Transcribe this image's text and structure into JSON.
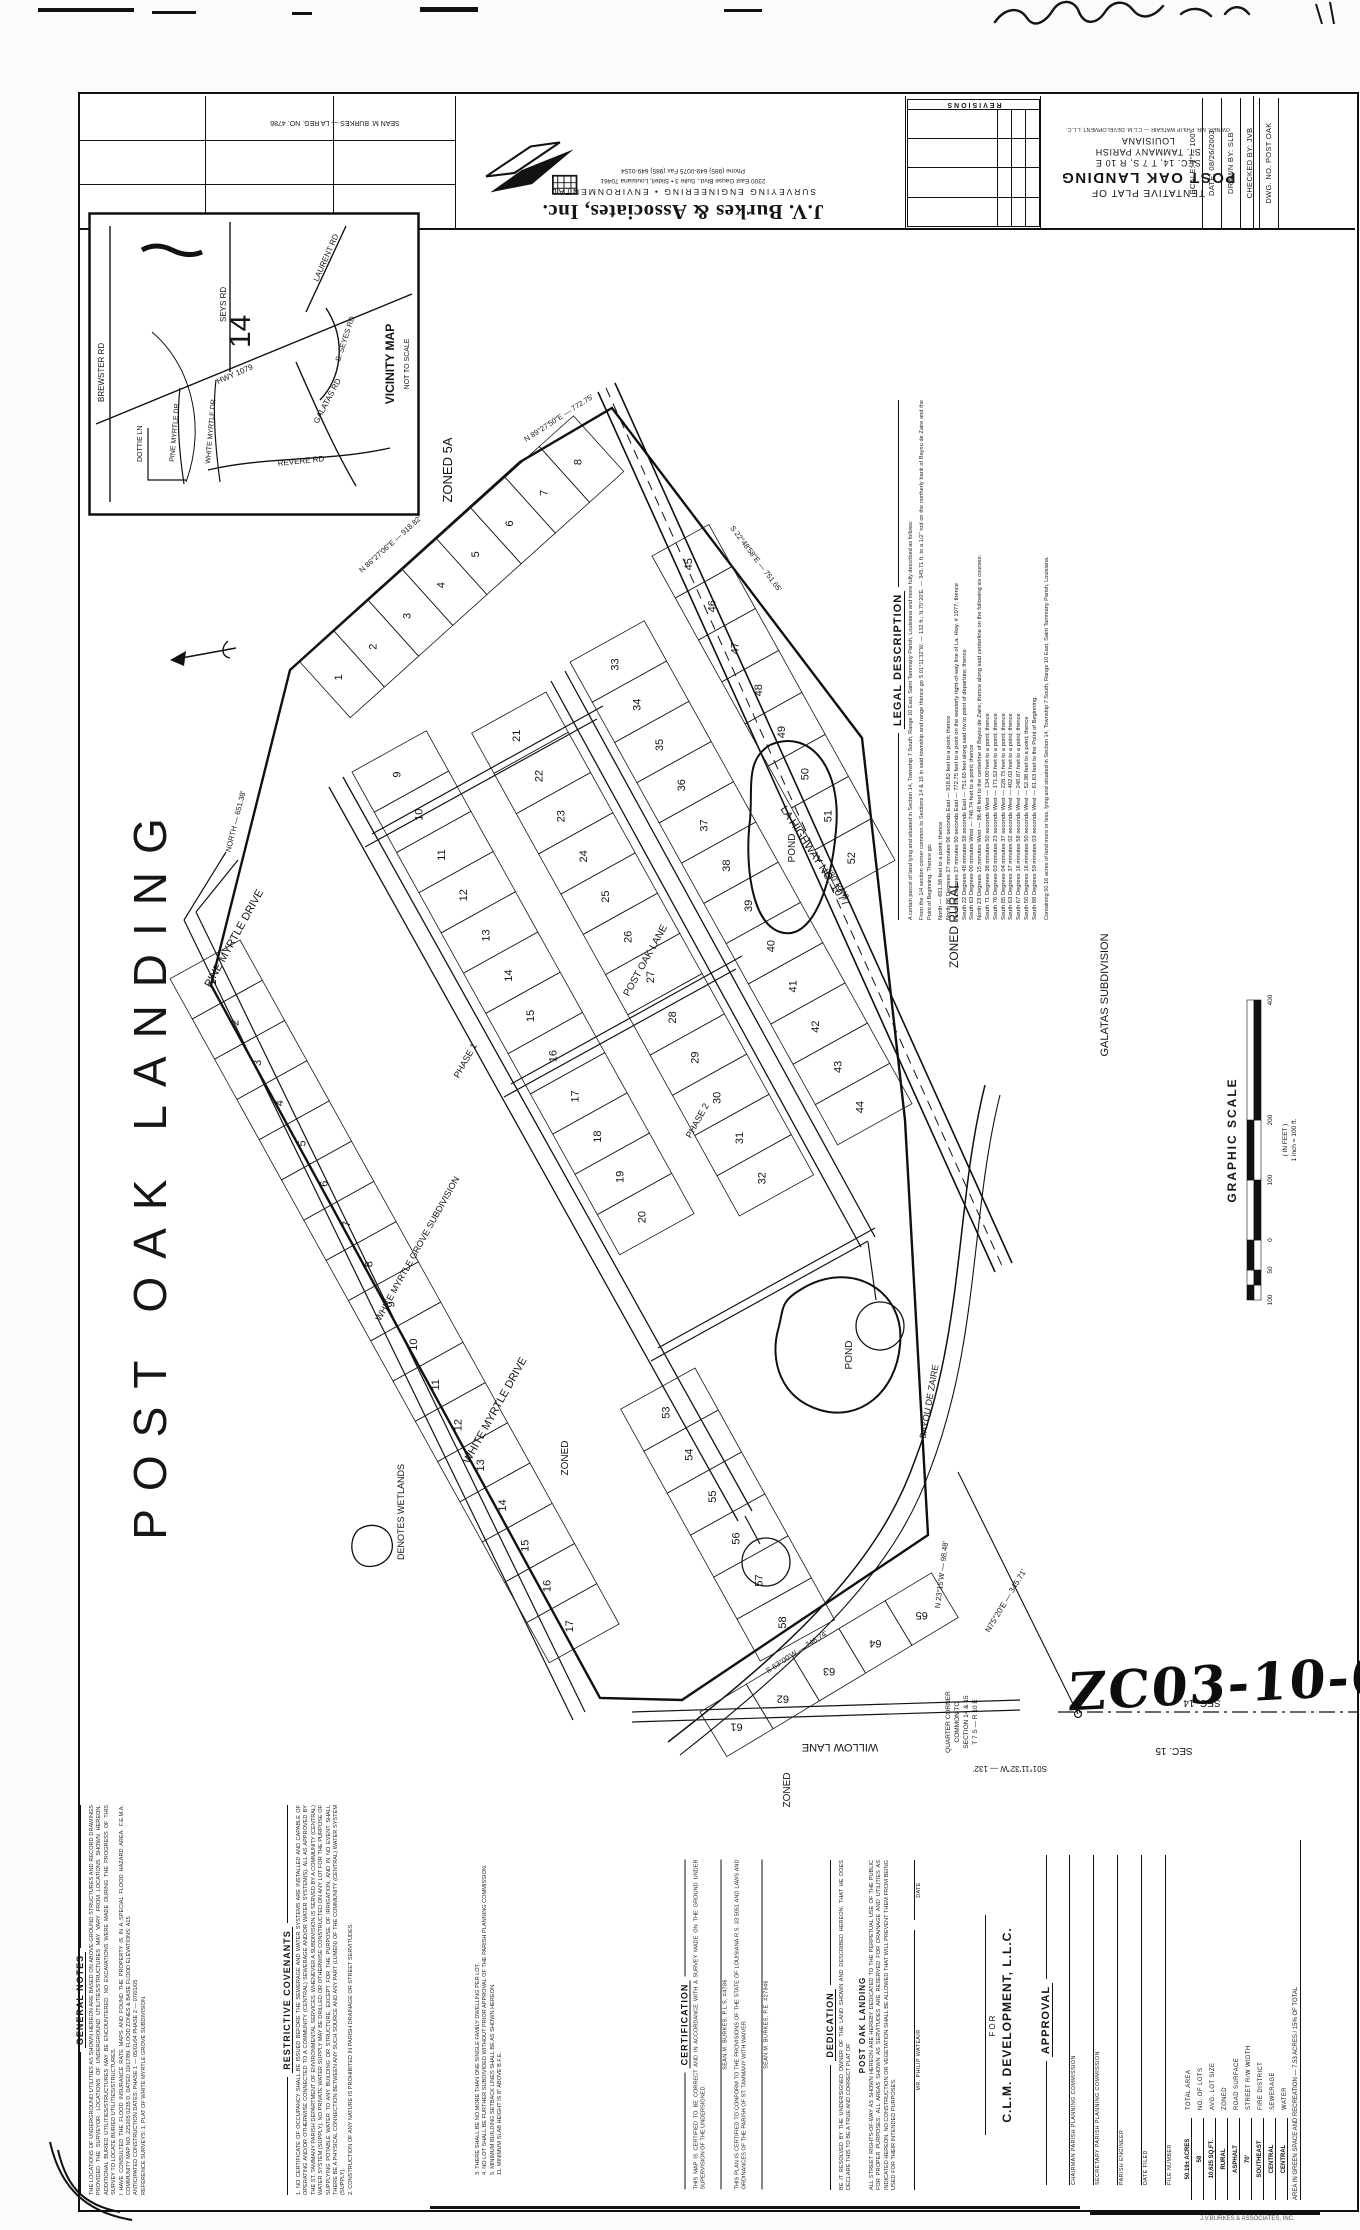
{
  "scan": {
    "case_number": "ZC03-10-067",
    "corner_stamp": "J.V.BURKES & ASSOCIATES, INC."
  },
  "title_block": {
    "surveyor_line": "SEAN M. BURKES — LA REG. NO. 4786",
    "firm_name": "J.V. Burkes & Associates, Inc.",
    "firm_services": "SURVEYING      ENGINEERING • ENVIRONMENTAL",
    "firm_address": "2300 East Gause Blvd., Suite 3  •  Slidell, Louisiana 70461",
    "firm_phone": "Phone (985) 649-0075      Fax (985) 649-0154",
    "revisions_title": "REVISIONS",
    "plat_title_line1": "TENTATIVE PLAT OF",
    "plat_title_line2": "POST OAK LANDING",
    "plat_title_line3": "SEC. 14, T 7 S, R 10 E",
    "plat_title_line4": "ST. TAMMANY PARISH",
    "plat_title_line5": "LOUISIANA",
    "owner_note": "OWNER: MR. PHILIP WATEAIR — C.L.M. DEVELOPMENT, L.L.C.",
    "fields": [
      "SCALE:  1\" = 100'",
      "DATE:  08/26/2003",
      "DRAWN BY:  SLB",
      "CHECKED BY:  JVB",
      "DWG. NO.  POST OAK"
    ]
  },
  "vicinity": {
    "title": "VICINITY MAP",
    "subtitle": "NOT TO SCALE",
    "section_number": "14",
    "roads": {
      "brewster": "BREWSTER RD",
      "hwy1079": "HWY 1079",
      "seys": "SEYS RD",
      "laurent": "LAURENT RD",
      "sseyes": "S. SEYES RD",
      "galatas": "GALATAS RD",
      "revere": "REVERE RD",
      "dottie": "DOTTIE LN",
      "pinemyrtle": "PINE MYRTLE DR",
      "whitemyrtle": "WHITE MYRTLE DR"
    }
  },
  "page_title": "POST OAK LANDING",
  "legal": {
    "heading": "LEGAL DESCRIPTION",
    "intro1": "A certain parcel of land lying and situated in Section 14, Township 7 South, Range 10 East, Saint Tammany Parish, Louisiana and more fully described as follows:",
    "intro2": "From the 1/4 section corner common to Sections 14 & 15 in said township and range thence go S.01°11'32\"W. — 132 ft.;  N.75°20'E. — 345.71 ft. to a 1/2\" rod on the northerly bank of Bayou de Zaire and the Point of Beginning. Thence go:",
    "courses": [
      "North — 651.38 feet to a point; thence",
      "North 86 Degrees 27 minutes 06 seconds East — 918.82 feet to a point; thence",
      "North 89 Degrees 27 minutes 50 seconds East — 772.75 feet to a point on the westerly right-of-way line of La. Hwy. # 1077; thence",
      "South 22 Degrees 48 minutes 58 seconds East — 751.65 feet along said r/w to point of departure; thence",
      "South 63 Degrees 00 minutes West — 746.74 feet to a point; thence",
      "North 23 Degrees 15 minutes West — 98.48 feet to the centerline of Bayou de Zaire; thence along said centerline on the following six courses:",
      "South 71 Degrees 38 minutes 50 seconds West — 134.00 feet to a point; thence",
      "South 76 Degrees 03 minutes 23 seconds West — 171.52 feet to a point; thence",
      "South 85 Degrees 04 minutes 37 seconds West — 228.75 feet to a point; thence",
      "South 63 Degrees 37 minutes 02 seconds West — 402.02 feet to a point; thence",
      "South 67 Degrees 16 minutes 58 seconds West — 240.87 feet to a point; thence",
      "South 50 Degrees 16 minutes 50 seconds West — 52.98 feet to a point; thence",
      "South 88 Degrees 59 minutes 03 seconds West — 61.63 feet to the Point of Beginning."
    ],
    "closing": "Containing 50.16 acres of land more or less, lying and situated in Section 14, Township 7 South, Range 10 East, Saint Tammany Parish, Louisiana."
  },
  "scalebar": {
    "title": "GRAPHIC SCALE",
    "units": "( IN FEET )",
    "ratio": "1 inch = 100 ft.",
    "segments": [
      15,
      15,
      30,
      60,
      60,
      120
    ],
    "ticks": [
      {
        "x": 5,
        "t": "100"
      },
      {
        "x": 35,
        "t": "50"
      },
      {
        "x": 65,
        "t": "0"
      },
      {
        "x": 125,
        "t": "100"
      },
      {
        "x": 185,
        "t": "200"
      },
      {
        "x": 305,
        "t": "400"
      }
    ]
  },
  "notes": {
    "heading": "GENERAL NOTES",
    "items": [
      "THE LOCATIONS OF UNDERGROUND UTILITIES AS SHOWN HEREON ARE BASED ON ABOVE-GROUND STRUCTURES AND RECORD DRAWINGS PROVIDED THE SURVEYOR. LOCATIONS OF UNDERGROUND UTILITIES/STRUCTURES MAY VARY FROM LOCATIONS SHOWN HEREON. ADDITIONAL BURIED UTILITIES/STRUCTURES MAY BE ENCOUNTERED. NO EXCAVATIONS WERE MADE DURING THE PROGRESS OF THIS SURVEY TO LOCATE BURIED UTILITIES/STRUCTURES.",
      "I HAVE CONSULTED THE FLOOD INSURANCE RATE MAPS AND FOUND THE PROPERTY IS IN A SPECIAL FLOOD HAZARD AREA.  F.E.M.A. COMMUNITY MAP NO. 225205 0235 D, DATED 10/17/89.  FLOOD ZONES & BASE FLOOD ELEVATIONS: A15",
      "ANTICIPATED CONSTRUCTION DATES:   PHASE 1 — 05/01/04    PHASE 2 — 07/01/05",
      "REFERENCE SURVEYS:   1. PLAT OF WHITE MYRTLE GROVE SUBDIVISION."
    ]
  },
  "covenants": {
    "heading": "RESTRICTIVE COVENANTS",
    "items": [
      "1.  NO CERTIFICATE OF OCCUPANCY SHALL BE ISSUED BEFORE THE SEWERAGE AND WATER SYSTEMS ARE INSTALLED AND CAPABLE OF OPERATING AND/OR OTHERWISE CONNECTED TO A COMMUNITY (CENTRAL) SEWERAGE AND/OR WATER SYSTEM(S), ALL AS APPROVED BY THE ST. TAMMANY PARISH DEPARTMENT OF ENVIRONMENTAL SERVICES. WHENEVER A SUBDIVISION IS SERVED BY A COMMUNITY (CENTRAL) WATER SYSTEM (SUPPLY), NO PRIVATE WATER SUPPLY MAY BE DRILLED OR OTHERWISE CONSTRUCTED ON ANY LOT FOR THE PURPOSE OF SUPPLYING POTABLE WATER TO ANY BUILDING OR STRUCTURE, EXCEPT FOR THE PURPOSE OF IRRIGATION, AND IN NO EVENT SHALL THERE BE A PHYSICAL CONNECTION BETWEEN ANY SUCH SOURCE AND ANY PART (LUMEN) OF THE COMMUNITY (CENTRAL) WATER SYSTEM (SUPPLY).",
      "2.  CONSTRUCTION OF ANY NATURE IS PROHIBITED IN PARISH DRAINAGE OR STREET SERVITUDES."
    ],
    "cont": [
      "3.  THERE SHALL BE NO MORE THAN ONE SINGLE FAMILY DWELLING PER LOT.",
      "4.  NO LOT SHALL BE FURTHER SUBDIVIDED WITHOUT PRIOR APPROVAL OF THE PARISH PLANNING COMMISSION.",
      "5.  MINIMUM BUILDING SETBACK LINES SHALL BE AS SHOWN HEREON.",
      "11. MINIMUM SLAB HEIGHT IS 8\" ABOVE B.F.E."
    ]
  },
  "certification": {
    "heading": "CERTIFICATION",
    "p1": "THIS MAP IS CERTIFIED TO BE CORRECT AND IN ACCORDANCE WITH A SURVEY MADE ON THE GROUND UNDER SUPERVISION OF THE UNDERSIGNED.",
    "sig1": "SEAN M. BURKES, P.L.S. #4786",
    "p2": "THIS PLAN IS CERTIFIED TO CONFORM TO THE PROVISIONS OF THE STATE OF LOUISIANA R.S. 33:5051 AND LAWS AND ORDINANCES OF THE PARISH OF ST. TAMMANY WITH WAIVER.",
    "sig2": "SEAN M. BURKES, P.E. #27946"
  },
  "dedication": {
    "heading": "DEDICATION",
    "p1": "BE IT RESOLVED BY THE UNDERSIGNED OWNER OF THE LAND SHOWN AND DESCRIBED HEREON, THAT HE DOES DECLARE THIS TO BE A TRUE AND CORRECT PLAT OF",
    "project": "POST OAK LANDING",
    "p2": "ALL STREET RIGHTS-OF-WAY AS SHOWN HEREON ARE HEREBY DEDICATED TO THE PERPETUAL USE OF THE PUBLIC FOR PROPER PURPOSES. ALL AREAS SHOWN AS SERVITUDES ARE RESERVED FOR DRAINAGE AND UTILITIES AS INDICATED HEREON. NO CONSTRUCTION OR VEGETATION SHALL BE ALLOWED THAT WILL PREVENT THEM FROM BEING USED FOR THEIR INTENDED PURPOSES.",
    "sig_owner": "MR. PHILIP WATEAIR",
    "sig_date": "DATE"
  },
  "owner_block": {
    "for_label": "FOR",
    "owner": "C.L.M. DEVELOPMENT, L.L.C."
  },
  "approval": {
    "heading": "APPROVAL",
    "lines": [
      "CHAIRMAN PARISH PLANNING COMMISSION",
      "SECRETARY PARISH PLANNING COMMISSION",
      "PARISH ENGINEER",
      "DATE FILED",
      "FILE NUMBER"
    ]
  },
  "site_data": {
    "rows": [
      {
        "v": "50.19± ACRES",
        "l": "TOTAL AREA"
      },
      {
        "v": "58",
        "l": "NO. OF LOTS"
      },
      {
        "v": "10,625 SQ.FT.",
        "l": "AVG. LOT SIZE"
      },
      {
        "v": "RURAL",
        "l": "ZONED"
      },
      {
        "v": "ASPHALT",
        "l": "ROAD SURFACE"
      },
      {
        "v": "70'",
        "l": "STREET R/W WIDTH"
      },
      {
        "v": "SOUTHEAST",
        "l": "FIRE DISTRICT"
      },
      {
        "v": "CENTRAL",
        "l": "SEWERAGE"
      },
      {
        "v": "CENTRAL",
        "l": "WATER"
      }
    ],
    "green": "AREA IN GREEN SPACE AND RECREATION — 7.53 ACRES / 15% OF TOTAL"
  },
  "plat": {
    "labels": [
      {
        "t": "ZONED 5A",
        "x": 452,
        "y": 470,
        "r": -90,
        "s": 13
      },
      {
        "t": "LA HIGHWAY NO. 1077",
        "x": 812,
        "y": 858,
        "r": 57,
        "s": 11
      },
      {
        "t": "(80' R/W)",
        "x": 836,
        "y": 886,
        "r": 57,
        "s": 8
      },
      {
        "t": "PINE MYRTLE DRIVE",
        "x": 237,
        "y": 940,
        "r": -61,
        "s": 11
      },
      {
        "t": "WHITE MYRTLE GROVE SUBDIVISION",
        "x": 420,
        "y": 1250,
        "r": -61,
        "s": 9
      },
      {
        "t": "WHITE MYRTLE DRIVE",
        "x": 498,
        "y": 1412,
        "r": -61,
        "s": 11
      },
      {
        "t": "POST OAK LANE",
        "x": 648,
        "y": 962,
        "r": -61,
        "s": 10
      },
      {
        "t": "POND",
        "x": 795,
        "y": 848,
        "r": -90,
        "s": 10
      },
      {
        "t": "POND",
        "x": 852,
        "y": 1355,
        "r": -90,
        "s": 10
      },
      {
        "t": "ZONED RURAL",
        "x": 958,
        "y": 925,
        "r": -90,
        "s": 12
      },
      {
        "t": "GALATAS SUBDIVISION",
        "x": 1108,
        "y": 995,
        "r": -90,
        "s": 11
      },
      {
        "t": "ZONED",
        "x": 568,
        "y": 1458,
        "r": -90,
        "s": 10
      },
      {
        "t": "ZONED",
        "x": 790,
        "y": 1790,
        "r": -90,
        "s": 10
      },
      {
        "t": "DENOTES WETLANDS",
        "x": 404,
        "y": 1512,
        "r": -90,
        "s": 9
      },
      {
        "t": "BAYOU DE ZAIRE",
        "x": 932,
        "y": 1402,
        "r": -80,
        "s": 9
      },
      {
        "t": "WILLOW LANE",
        "x": 840,
        "y": 1744,
        "r": 180,
        "s": 11
      },
      {
        "t": "SEC. 14",
        "x": 1202,
        "y": 1700,
        "r": 180,
        "s": 10
      },
      {
        "t": "SEC. 15",
        "x": 1174,
        "y": 1748,
        "r": 180,
        "s": 10
      },
      {
        "t": "QUARTER CORNER",
        "x": 950,
        "y": 1722,
        "r": -90,
        "s": 6.5
      },
      {
        "t": "COMMON TO",
        "x": 959,
        "y": 1722,
        "r": -90,
        "s": 6.5
      },
      {
        "t": "SECTION 14 & 15",
        "x": 968,
        "y": 1722,
        "r": -90,
        "s": 6.5
      },
      {
        "t": "T 7 S — R 10 E",
        "x": 977,
        "y": 1722,
        "r": -90,
        "s": 6.5
      },
      {
        "t": "S01°11'32\"W — 132'",
        "x": 1010,
        "y": 1766,
        "r": 180,
        "s": 8
      },
      {
        "t": "N75°20'E — 345.71'",
        "x": 1008,
        "y": 1602,
        "r": -59,
        "s": 8
      },
      {
        "t": "NORTH — 651.38'",
        "x": 238,
        "y": 822,
        "r": -76,
        "s": 7.5
      },
      {
        "t": "N 86°27'06\"E — 918.82'",
        "x": 392,
        "y": 546,
        "r": -42,
        "s": 7.5
      },
      {
        "t": "N 89°27'50\"E — 772.75'",
        "x": 560,
        "y": 420,
        "r": -33,
        "s": 7.5
      },
      {
        "t": "S 22°48'58\"E — 751.65'",
        "x": 754,
        "y": 560,
        "r": 53,
        "s": 7.5
      },
      {
        "t": "S 63°00'W — 746.74'",
        "x": 798,
        "y": 1654,
        "r": -33,
        "s": 7.5
      },
      {
        "t": "N 23°15'W — 98.48'",
        "x": 944,
        "y": 1575,
        "r": -83,
        "s": 7.5
      },
      {
        "t": "PHASE 1",
        "x": 468,
        "y": 1062,
        "r": -61,
        "s": 9
      },
      {
        "t": "PHASE 2",
        "x": 700,
        "y": 1122,
        "r": -61,
        "s": 9
      }
    ],
    "strips": [
      {
        "x": 240,
        "y": 940,
        "a": 61,
        "n": 17,
        "w": 46,
        "d": -80,
        "start": 1
      },
      {
        "x": 300,
        "y": 662,
        "a": -42,
        "n": 8,
        "w": 46,
        "d": -75,
        "start": 1
      },
      {
        "x": 352,
        "y": 772,
        "a": 61,
        "n": 12,
        "w": 46,
        "d": 85,
        "start": 9
      },
      {
        "x": 546,
        "y": 692,
        "a": 61,
        "n": 12,
        "w": 46,
        "d": -85,
        "start": 21
      },
      {
        "x": 570,
        "y": 662,
        "a": 61,
        "n": 12,
        "w": 46,
        "d": 85,
        "start": 33
      },
      {
        "x": 652,
        "y": 556,
        "a": 61,
        "n": 8,
        "w": 48,
        "d": 65,
        "start": 45
      },
      {
        "x": 695,
        "y": 1368,
        "a": 61,
        "n": 6,
        "w": 48,
        "d": -85,
        "start": 53
      },
      {
        "x": 700,
        "y": 1712,
        "a": -31,
        "n": 5,
        "w": 54,
        "d": -52,
        "start": 61,
        "nr": 180
      }
    ]
  }
}
